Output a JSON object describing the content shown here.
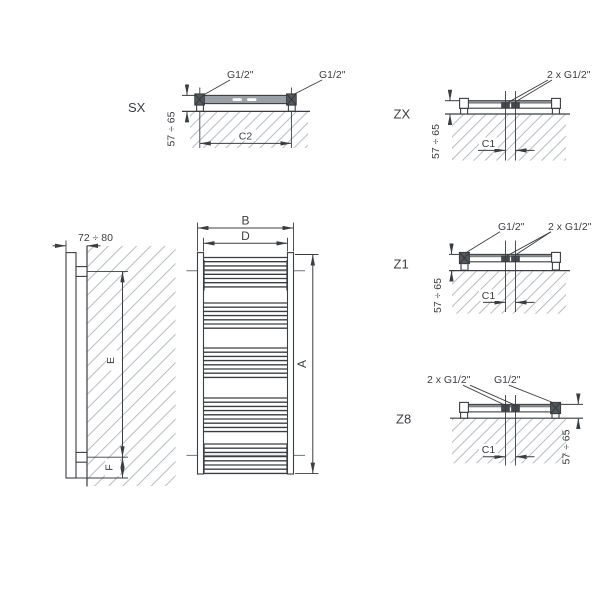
{
  "drawing_type": "radiator-technical-dimension-diagram",
  "views": {
    "sx": {
      "label": "SX",
      "connection_left": "G1/2\"",
      "connection_right": "G1/2\"",
      "span_dim": "C2",
      "wall_offset_dim": "57 ÷ 65"
    },
    "zx": {
      "label": "ZX",
      "connection_center": "2 x G1/2\"",
      "span_dim": "C1",
      "wall_offset_dim": "57 ÷ 65"
    },
    "z1": {
      "label": "Z1",
      "connection_left": "G1/2\"",
      "connection_center": "2 x G1/2\"",
      "span_dim": "C1",
      "wall_offset_dim": "57 ÷ 65"
    },
    "z8": {
      "label": "Z8",
      "connection_center": "2 x G1/2\"",
      "connection_right": "G1/2\"",
      "span_dim": "C1",
      "wall_offset_dim": "57 ÷ 65"
    },
    "side": {
      "depth_dim": "72 ÷ 80",
      "height_dim": "E",
      "bottom_dim": "F"
    },
    "front": {
      "width_dim": "B",
      "rung_span_dim": "D",
      "height_dim": "A",
      "rung_spacing": 4.2,
      "rung_groups": [
        {
          "y": 257.5,
          "count": 8
        },
        {
          "y": 303.0,
          "count": 7
        },
        {
          "y": 348.0,
          "count": 8
        },
        {
          "y": 398.0,
          "count": 9
        },
        {
          "y": 444.0,
          "count": 8
        }
      ]
    }
  },
  "colors": {
    "line": "#3a3d42",
    "hatch": "#b9bec4",
    "bar_fill": "#9aa0a5",
    "block_fill": "#54585c"
  }
}
